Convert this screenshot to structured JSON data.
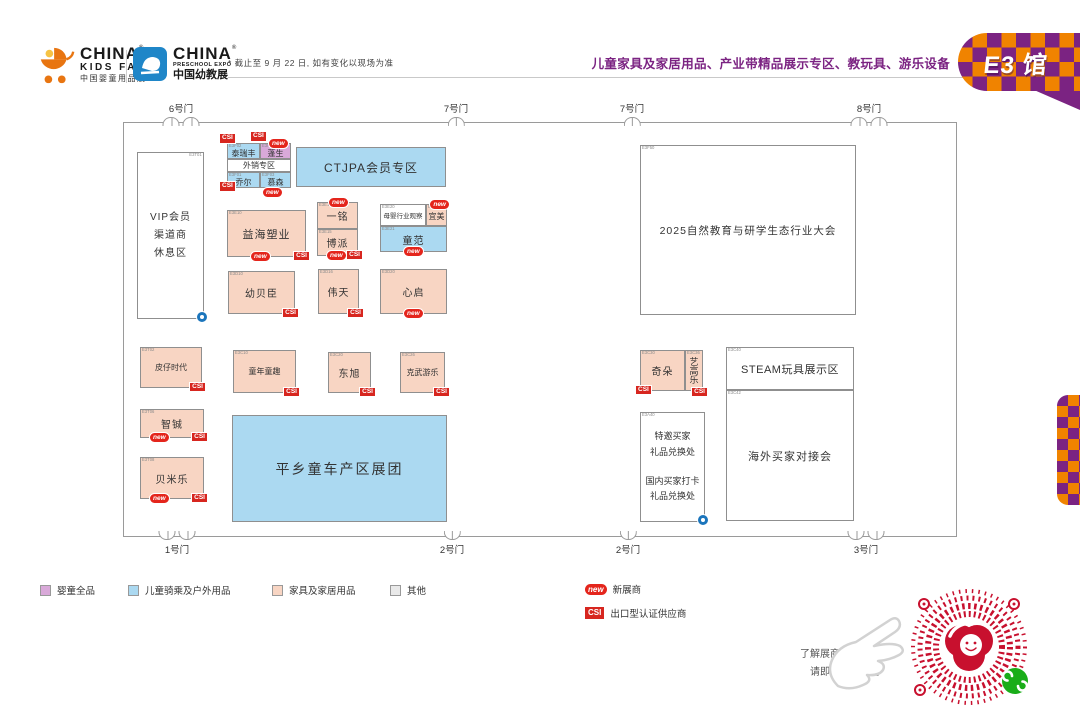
{
  "badges": {
    "csi": "CSI",
    "new": "new"
  },
  "header": {
    "kids_fair": {
      "line1": "CHINA",
      "line2": "KIDS FAIR",
      "line3": "中国婴童用品展"
    },
    "preschool": {
      "line1": "CHINA",
      "line2": "PRESCHOOL EXPO",
      "line3": "中国幼教展"
    },
    "reg": "®",
    "note": "* 截止至 9 月 22 日, 如有变化以现场为准",
    "title": "儿童家具及家居用品、产业带精品展示专区、教玩具、游乐设备",
    "hall": "E3 馆"
  },
  "gates": {
    "top": [
      "6号门",
      "7号门",
      "7号门",
      "8号门"
    ],
    "bottom": [
      "1号门",
      "2号门",
      "2号门",
      "3号门"
    ]
  },
  "booths": {
    "vip": {
      "code": "E3T01",
      "line1": "VIP会员",
      "line2": "渠道商",
      "line3": "休息区"
    },
    "tairuifeng": {
      "code": "E3F02",
      "name": "泰瑞丰"
    },
    "pengsheng": {
      "code": "E3F08",
      "name": "蓬生"
    },
    "waixiao": {
      "name": "外销专区"
    },
    "qiaoer": {
      "code": "E3F01",
      "name": "乔尔"
    },
    "musen": {
      "code": "E3F03",
      "name": "慕森"
    },
    "ctjpa": {
      "name": "CTJPA会员专区"
    },
    "yihai": {
      "code": "E3E10",
      "name": "益海塑业"
    },
    "yiming": {
      "code": "E3E16",
      "name": "一铭"
    },
    "bopai": {
      "code": "E3E15",
      "name": "博派"
    },
    "muying": {
      "code": "E3E20",
      "name": "母婴行业观察"
    },
    "yimei": {
      "code": "E3E26",
      "name": "宜美"
    },
    "tongfan": {
      "code": "E3E21",
      "name": "童范"
    },
    "youbeichen": {
      "code": "E3D10",
      "name": "幼贝臣"
    },
    "weitian": {
      "code": "E3D16",
      "name": "伟天"
    },
    "xinqi": {
      "code": "E3D20",
      "name": "心启"
    },
    "pizai": {
      "code": "E3T02",
      "name": "皮仔时代"
    },
    "zhicheng": {
      "code": "E3T06",
      "name": "智铖"
    },
    "beimile": {
      "code": "E3T08",
      "name": "贝米乐"
    },
    "tongnian": {
      "code": "E3C10",
      "name": "童年童趣"
    },
    "dongxu": {
      "code": "E3C20",
      "name": "东旭"
    },
    "kewu": {
      "code": "E3C26",
      "name": "克武游乐"
    },
    "pingxiang": {
      "name": "平乡童车产区展团"
    },
    "conference": {
      "code": "E3F50",
      "name": "2025自然教育与研学生态行业大会"
    },
    "qiduo": {
      "code": "E3C30",
      "name": "奇朵"
    },
    "yigaole": {
      "code": "E3C36",
      "name": "艺高乐"
    },
    "steam": {
      "code": "E3C40",
      "name": "STEAM玩具展示区"
    },
    "haiwai": {
      "code": "E3C42",
      "name": "海外买家对接会"
    },
    "tejiao": {
      "code": "E3A40",
      "line1": "特邀买家",
      "line2": "礼品兑换处",
      "line3": "国内买家打卡",
      "line4": "礼品兑换处"
    }
  },
  "legend": {
    "items": [
      {
        "label": "婴童全品",
        "color": "#D9A9D9"
      },
      {
        "label": "儿童骑乘及户外用品",
        "color": "#ABD9F1"
      },
      {
        "label": "家具及家居用品",
        "color": "#F8D5C3"
      },
      {
        "label": "其他",
        "color": "#E9E9E9"
      },
      {
        "label": "新展商",
        "color": "#E4251C"
      },
      {
        "label": "出口型认证供应商",
        "color": "#D7261F"
      }
    ]
  },
  "footer": {
    "line1": "了解展商详细信息",
    "line2": "请即刻扫码查询"
  },
  "colors": {
    "accent_purple": "#7B2382",
    "accent_orange": "#F08300",
    "booth_blue": "#ABD9F1",
    "booth_salmon": "#F8D5C3",
    "booth_purple": "#D9A9D9",
    "csi_red": "#D7261F",
    "new_red": "#E4251C",
    "qr_red": "#C8102E",
    "wechat_green": "#1AAD19",
    "dot_blue": "#1B75BC"
  }
}
